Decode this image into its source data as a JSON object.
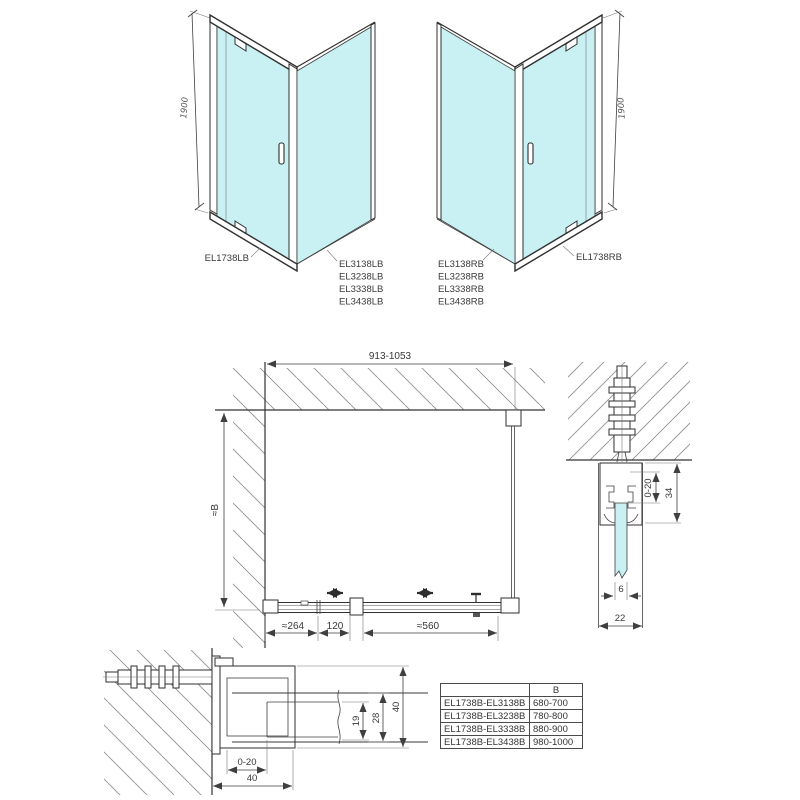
{
  "colors": {
    "glass": "#c9f0f2",
    "line": "#3a3a3a",
    "hatch": "#8f8f8f",
    "text": "#383838"
  },
  "iso_left": {
    "height_dim": "1900",
    "door_label": "EL1738LB",
    "panel_labels": [
      "EL3138LB",
      "EL3238LB",
      "EL3338LB",
      "EL3438LB"
    ]
  },
  "iso_right": {
    "height_dim": "1900",
    "door_label": "EL1738RB",
    "panel_labels": [
      "EL3138RB",
      "EL3238RB",
      "EL3338RB",
      "EL3438RB"
    ]
  },
  "plan": {
    "width_range": "913-1053",
    "depth_label": "≈B",
    "fixed_section": "≈264",
    "adjust_section": "120",
    "door_opening": "≈560"
  },
  "wall_profile_front": {
    "adjust": "0-20",
    "depth": "34",
    "glass_thickness": "6",
    "width": "22"
  },
  "wall_profile_top": {
    "engagement": "19",
    "frame_depth": "28",
    "profile_depth": "40",
    "adjust": "0-20",
    "width": "40"
  },
  "size_table": {
    "col_header": "B",
    "rows": [
      {
        "models": "EL1738B-EL3138B",
        "b": "680-700"
      },
      {
        "models": "EL1738B-EL3238B",
        "b": "780-800"
      },
      {
        "models": "EL1738B-EL3338B",
        "b": "880-900"
      },
      {
        "models": "EL1738B-EL3438B",
        "b": "980-1000"
      }
    ]
  }
}
